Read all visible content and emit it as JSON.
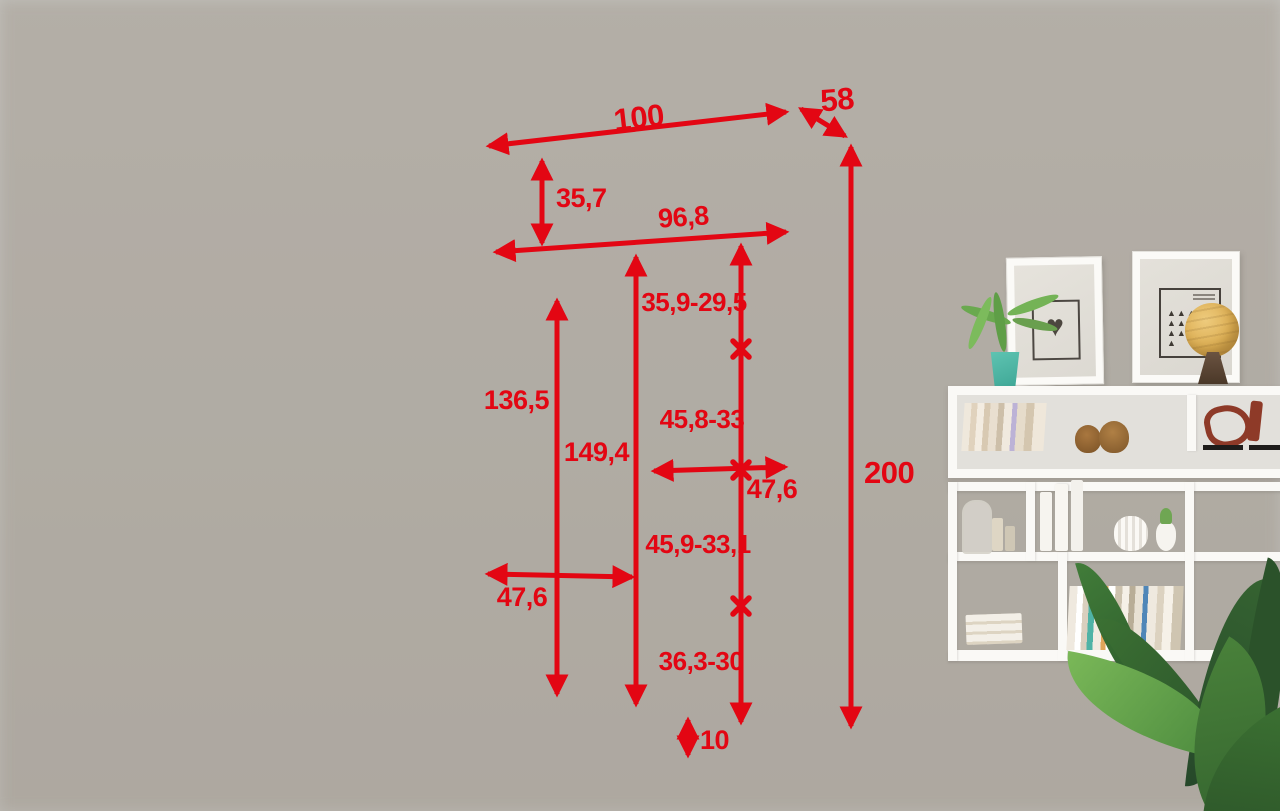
{
  "title": "Wardrobe interior dimension diagram",
  "dimensions": {
    "top_width": "100",
    "depth": "58",
    "total_height": "200",
    "top_shelf_gap": "35,7",
    "inner_width": "96,8",
    "interior_height": "149,4",
    "hanging_height": "136,5",
    "left_section_width": "47,6",
    "right_col_gap1": "35,9-29,5",
    "right_col_gap2": "45,8-33",
    "right_col_width": "47,6",
    "right_col_gap3": "45,9-33,1",
    "right_col_gap4": "36,3-30",
    "plinth_height": "10"
  },
  "colors": {
    "dimension_red": "#e30613",
    "panel_gray": "#7e8083",
    "wardrobe_white": "#f8f7f4",
    "floor_wood": "#e9d8bf"
  }
}
